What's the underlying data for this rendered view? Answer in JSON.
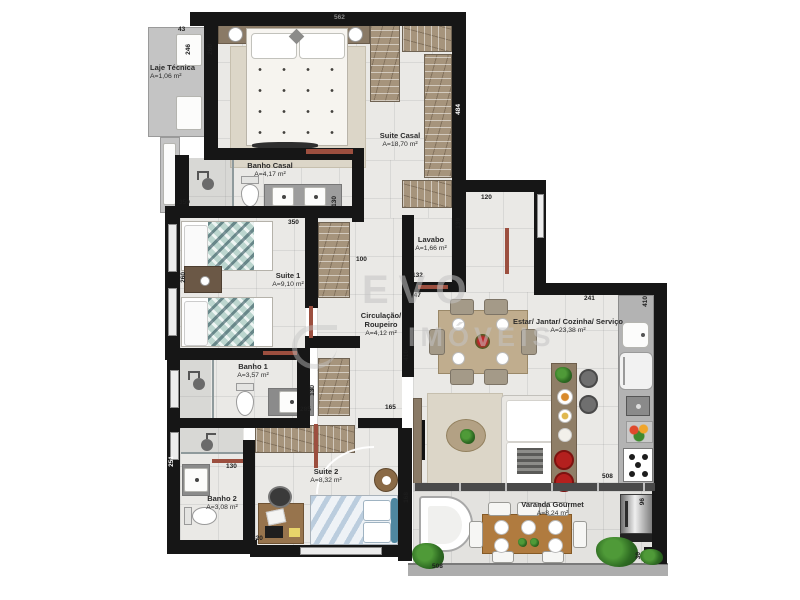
{
  "watermark": {
    "line1": "EVO",
    "line2": "IMÓVEIS"
  },
  "rooms": [
    {
      "name": "Laje Técnica",
      "area": "A=1,06 m²"
    },
    {
      "name": "Suite Casal",
      "area": "A=18,70 m²"
    },
    {
      "name": "Banho Casal",
      "area": "A=4,17 m²"
    },
    {
      "name": "Suite 1",
      "area": "A=9,10 m²"
    },
    {
      "name": "Lavabo",
      "area": "A=1,66 m²"
    },
    {
      "name": "Circulação/ Roupeiro",
      "area": "A=4,12 m²"
    },
    {
      "name": "Banho 1",
      "area": "A=3,57 m²"
    },
    {
      "name": "Banho 2",
      "area": "A=3,08 m²"
    },
    {
      "name": "Suite 2",
      "area": "A=8,32 m²"
    },
    {
      "name": "Estar/ Jantar/ Cozinha/ Serviço",
      "area": "A=23,38 m²"
    },
    {
      "name": "Varanda Gourmet",
      "area": "A=8,24 m²"
    }
  ],
  "dims": [
    "43",
    "246",
    "260",
    "562",
    "484",
    "350",
    "130",
    "350",
    "100",
    "260",
    "120",
    "130",
    "132",
    "147",
    "241",
    "410",
    "410",
    "130",
    "285",
    "165",
    "251",
    "130",
    "320",
    "508",
    "508",
    "168",
    "96",
    "30"
  ],
  "colors": {
    "wall": "#161616",
    "floor": "#eae9e6",
    "wardrobe": "#a6947c",
    "wood": "#8a7a66",
    "door": "#9c4f3f",
    "stool_red": "#b4201e",
    "plant_green": "#2e6b22",
    "watermark_gray": "#c3c3c3"
  },
  "icons": {
    "shower-icon": "circle-with-arm css shape",
    "lamp-icon": "white circle",
    "plant-icon": "green radial blob",
    "burner-icon": "four black dots",
    "grill-icon": "metallic gradient cylinder"
  }
}
